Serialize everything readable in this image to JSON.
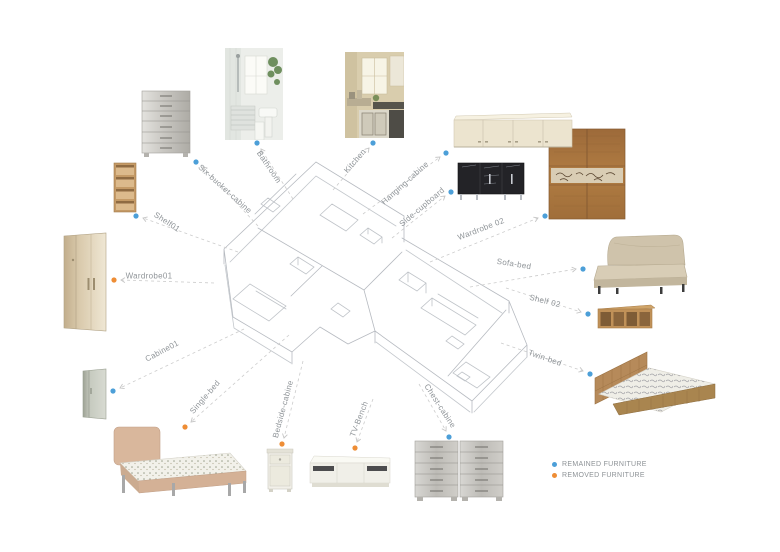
{
  "colors": {
    "remained": "#4c9fd8",
    "removed": "#ee8d35",
    "connector": "#cccccc",
    "plan_line": "#b6bac0",
    "label_text": "#8f9498"
  },
  "legend": {
    "remained_label": "REMAINED FURNITURE",
    "removed_label": "REMOVED FURNITURE"
  },
  "items": [
    {
      "id": "six-bucket-cabine",
      "label": "Six-bucket-cabine",
      "status": "remained"
    },
    {
      "id": "bathroom",
      "label": "Bathroom",
      "status": "remained"
    },
    {
      "id": "kitchen",
      "label": "Kitchen",
      "status": "remained"
    },
    {
      "id": "hanging-cabine",
      "label": "Hanging-cabine",
      "status": "remained"
    },
    {
      "id": "side-cupboard",
      "label": "Side-cupboard",
      "status": "remained"
    },
    {
      "id": "wardrobe-02",
      "label": "Wardrobe 02",
      "status": "remained"
    },
    {
      "id": "sofa-bed",
      "label": "Sofa-bed",
      "status": "remained"
    },
    {
      "id": "shelf-02",
      "label": "Shelf 02",
      "status": "remained"
    },
    {
      "id": "twin-bed",
      "label": "Twin-bed",
      "status": "remained"
    },
    {
      "id": "chest-cabine",
      "label": "Chest-cabine",
      "status": "remained"
    },
    {
      "id": "tv-bench",
      "label": "TV-Bench",
      "status": "removed"
    },
    {
      "id": "bedside-cabine",
      "label": "Bedside-cabine",
      "status": "removed"
    },
    {
      "id": "single-bed",
      "label": "Single-bed",
      "status": "removed"
    },
    {
      "id": "cabine01",
      "label": "Cabine01",
      "status": "remained"
    },
    {
      "id": "wardrobe01",
      "label": "Wardrobe01",
      "status": "removed"
    },
    {
      "id": "shelf01",
      "label": "Shelf01",
      "status": "remained"
    }
  ]
}
